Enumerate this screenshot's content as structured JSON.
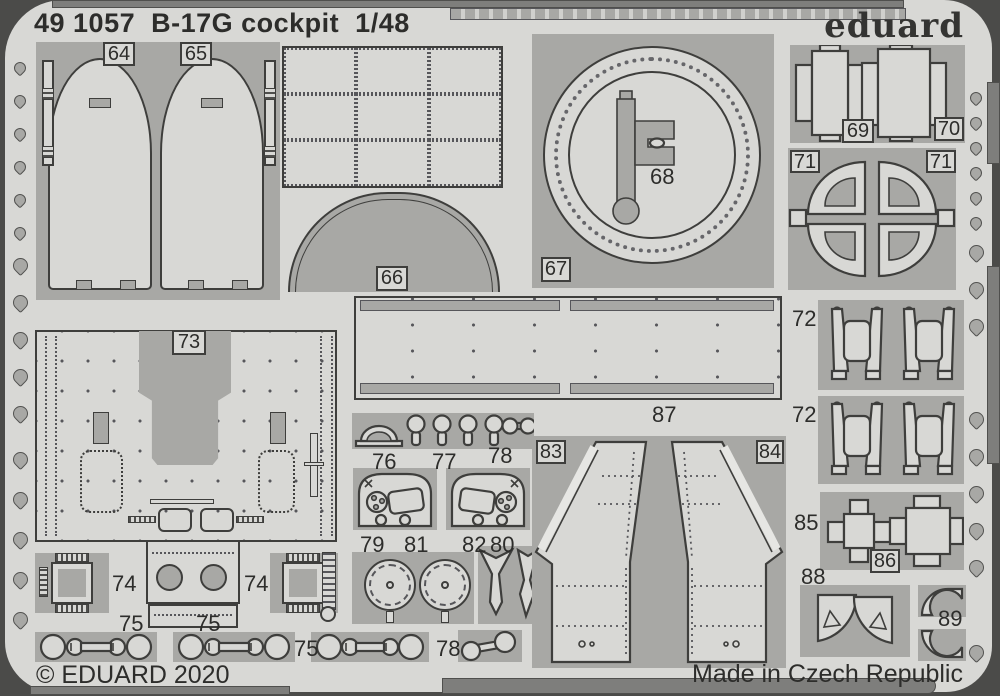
{
  "header": {
    "catalog": "49 1057",
    "title": "B-17G  cockpit",
    "scale": "1/48",
    "brand": "eduard"
  },
  "footer": {
    "copyright": "© EDUARD 2020",
    "origin": "Made in Czech Republic"
  },
  "colors": {
    "fret": "#d8d8d5",
    "part_block": "#a8a8a5",
    "outline": "#3e3e3c",
    "rail": "#7e7e7c",
    "background": "#4b4b49",
    "text": "#2d2d2b"
  },
  "part_labels": {
    "p64": "64",
    "p65": "65",
    "p66": "66",
    "p67": "67",
    "p68": "68",
    "p69": "69",
    "p70": "70",
    "p71a": "71",
    "p71b": "71",
    "p72a": "72",
    "p72b": "72",
    "p73": "73",
    "p74a": "74",
    "p74b": "74",
    "p75a": "75",
    "p75b": "75",
    "p75c": "75",
    "p76": "76",
    "p77": "77",
    "p78a": "78",
    "p78b": "78",
    "p79": "79",
    "p80": "80",
    "p81": "81",
    "p82": "82",
    "p83": "83",
    "p84": "84",
    "p85": "85",
    "p86": "86",
    "p87": "87",
    "p88": "88",
    "p89": "89"
  }
}
